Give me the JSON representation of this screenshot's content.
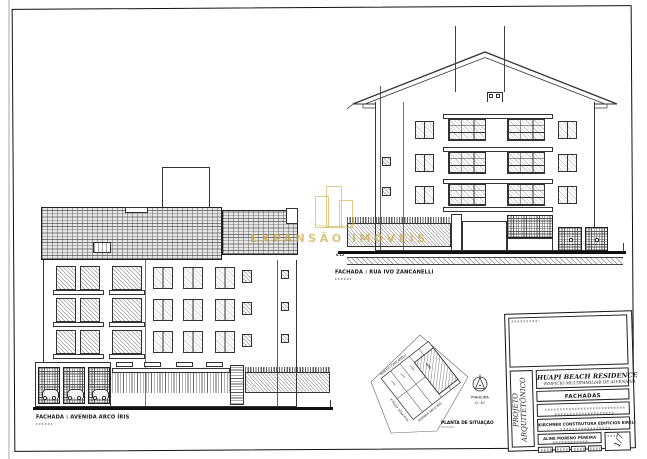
{
  "watermark": {
    "text": "EXPANSÃO IMÓVEIS"
  },
  "left_facade": {
    "label": "FACHADA : AVENIDA ARCO ÍRIS"
  },
  "right_facade": {
    "label": "FACHADA : RUA IVO ZANCANELLI",
    "dim_note": "0.12"
  },
  "site_plan": {
    "label": "PLANTA DE SITUAÇÃO",
    "street_top": "RUA IVO ZANCANELLI",
    "street_bottom": "AVENIDA ARCO ÍRIS",
    "street_left": "RUA PROF. ESTELA",
    "district": "PINHEIRA",
    "block_ref": "Q : A7",
    "lot_label": "LOTE"
  },
  "title_block": {
    "side_label_line1": "PROJETO",
    "side_label_line2": "ARQUITETÔNICO",
    "project_title": "HUAPI BEACH RESIDENCE",
    "project_subtitle": "EDIFÍCIO MULTIFAMILIAR DE ALVENARIA",
    "sheet_content": "FACHADAS",
    "owner": "KIRCHNER CONSTRUTORA EDIFÍCIOS EIRELI",
    "author": "ALINE MORENO PEREIRA",
    "sheet_number": "1/7"
  }
}
